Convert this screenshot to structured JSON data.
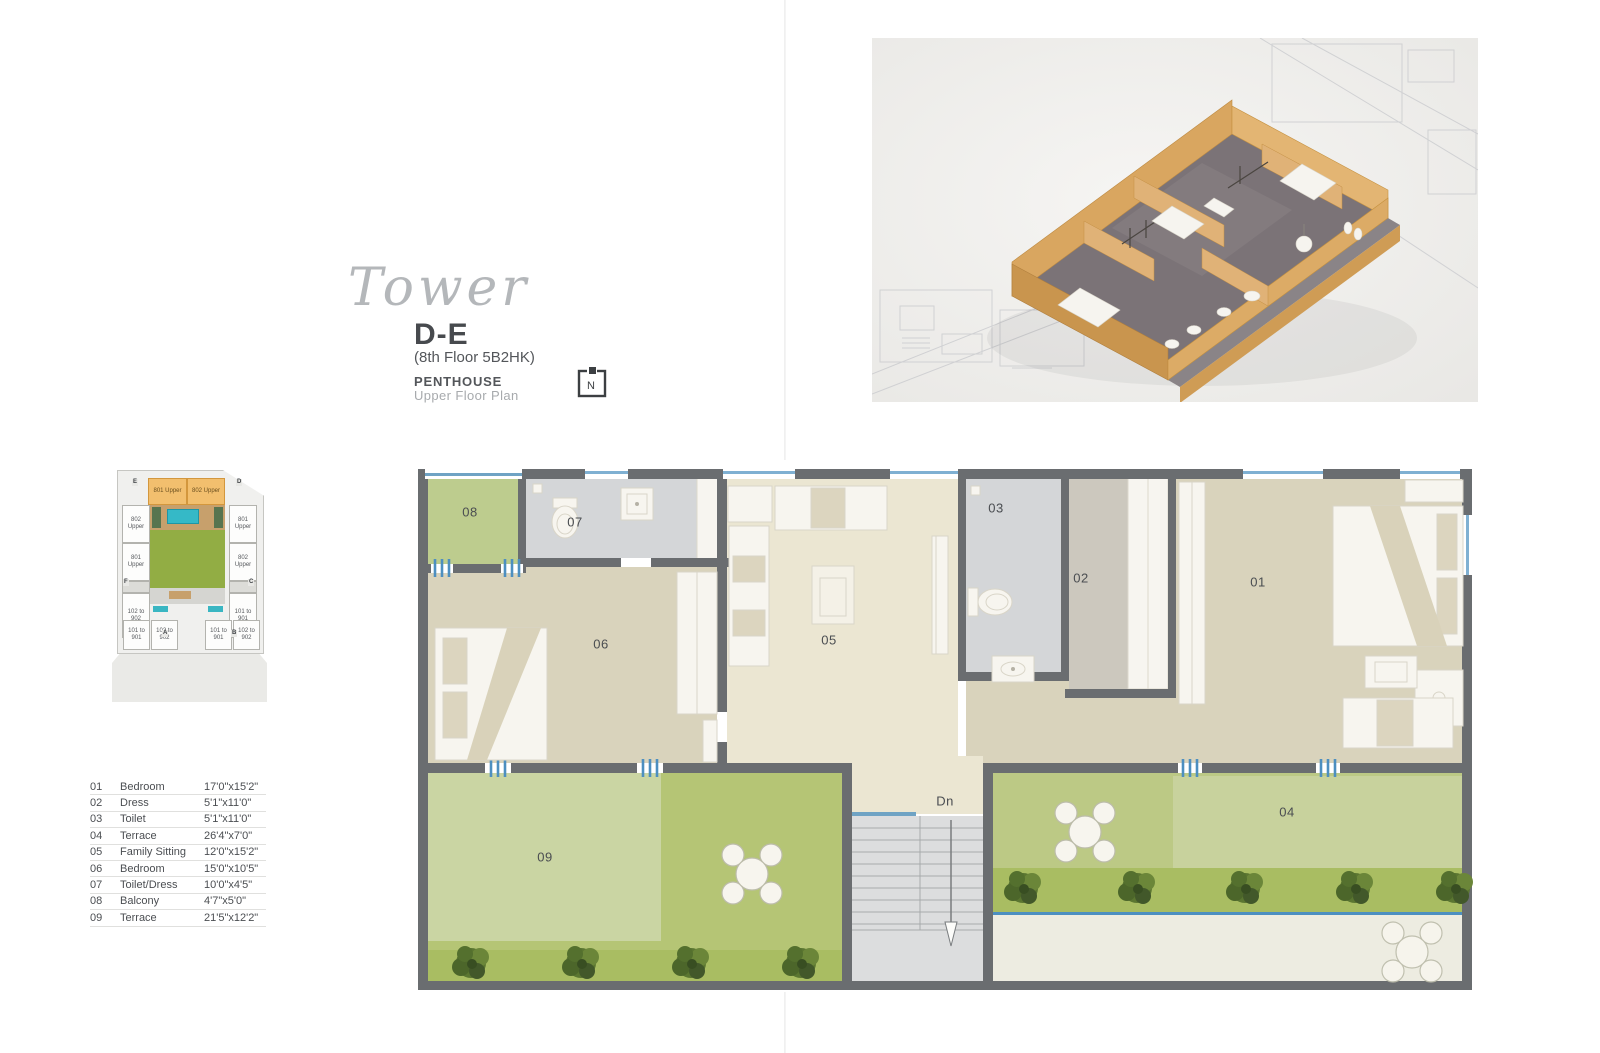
{
  "title_block": {
    "script_title": "Tower",
    "tower_name": "D-E",
    "floor_info": "(8th Floor 5B2HK)",
    "plan_type": "PENTHOUSE",
    "plan_subtype": "Upper Floor Plan"
  },
  "north": {
    "label": "N"
  },
  "key_plan": {
    "top_units": [
      "801 Upper",
      "802 Upper"
    ],
    "left_units": [
      "802 Upper",
      "801 Upper",
      "102 to 902"
    ],
    "right_units": [
      "801 Upper",
      "802 Upper",
      "101 to 901"
    ],
    "bottom_left_units": [
      "101 to 901",
      "102 to 902"
    ],
    "bottom_right_units": [
      "101 to 901",
      "102 to 902"
    ],
    "letters": {
      "e": "E",
      "d": "D",
      "f": "F",
      "c": "C",
      "a": "A",
      "b": "B"
    }
  },
  "legend": {
    "rows": [
      {
        "num": "01",
        "name": "Bedroom",
        "size": "17'0\"x15'2\""
      },
      {
        "num": "02",
        "name": "Dress",
        "size": "5'1\"x11'0\""
      },
      {
        "num": "03",
        "name": "Toilet",
        "size": "5'1\"x11'0\""
      },
      {
        "num": "04",
        "name": "Terrace",
        "size": "26'4\"x7'0\""
      },
      {
        "num": "05",
        "name": "Family Sitting",
        "size": "12'0\"x15'2\""
      },
      {
        "num": "06",
        "name": "Bedroom",
        "size": "15'0\"x10'5\""
      },
      {
        "num": "07",
        "name": "Toilet/Dress",
        "size": "10'0\"x4'5\""
      },
      {
        "num": "08",
        "name": "Balcony",
        "size": "4'7\"x5'0\""
      },
      {
        "num": "09",
        "name": "Terrace",
        "size": "21'5\"x12'2\""
      }
    ]
  },
  "plan": {
    "labels": {
      "r01": "01",
      "r02": "02",
      "r03": "03",
      "r04": "04",
      "r05": "05",
      "r06": "06",
      "r07": "07",
      "r08": "08",
      "r09": "09",
      "dn": "Dn"
    }
  },
  "colors": {
    "wall_gray": "#6a6d70",
    "room_tan": "#d9d3bc",
    "room_cream": "#ebe6d2",
    "room_gray": "#d4d6d8",
    "terrace_green_light": "#cad5a3",
    "terrace_green_dark": "#b5c575",
    "tree_band_green": "#a9bd62",
    "window_blue": "#4d8fc0",
    "keyplan_highlight_orange": "#f2bf6e",
    "keyplan_lawn_green": "#92ad44",
    "keyplan_pool_teal": "#35b9c7"
  }
}
